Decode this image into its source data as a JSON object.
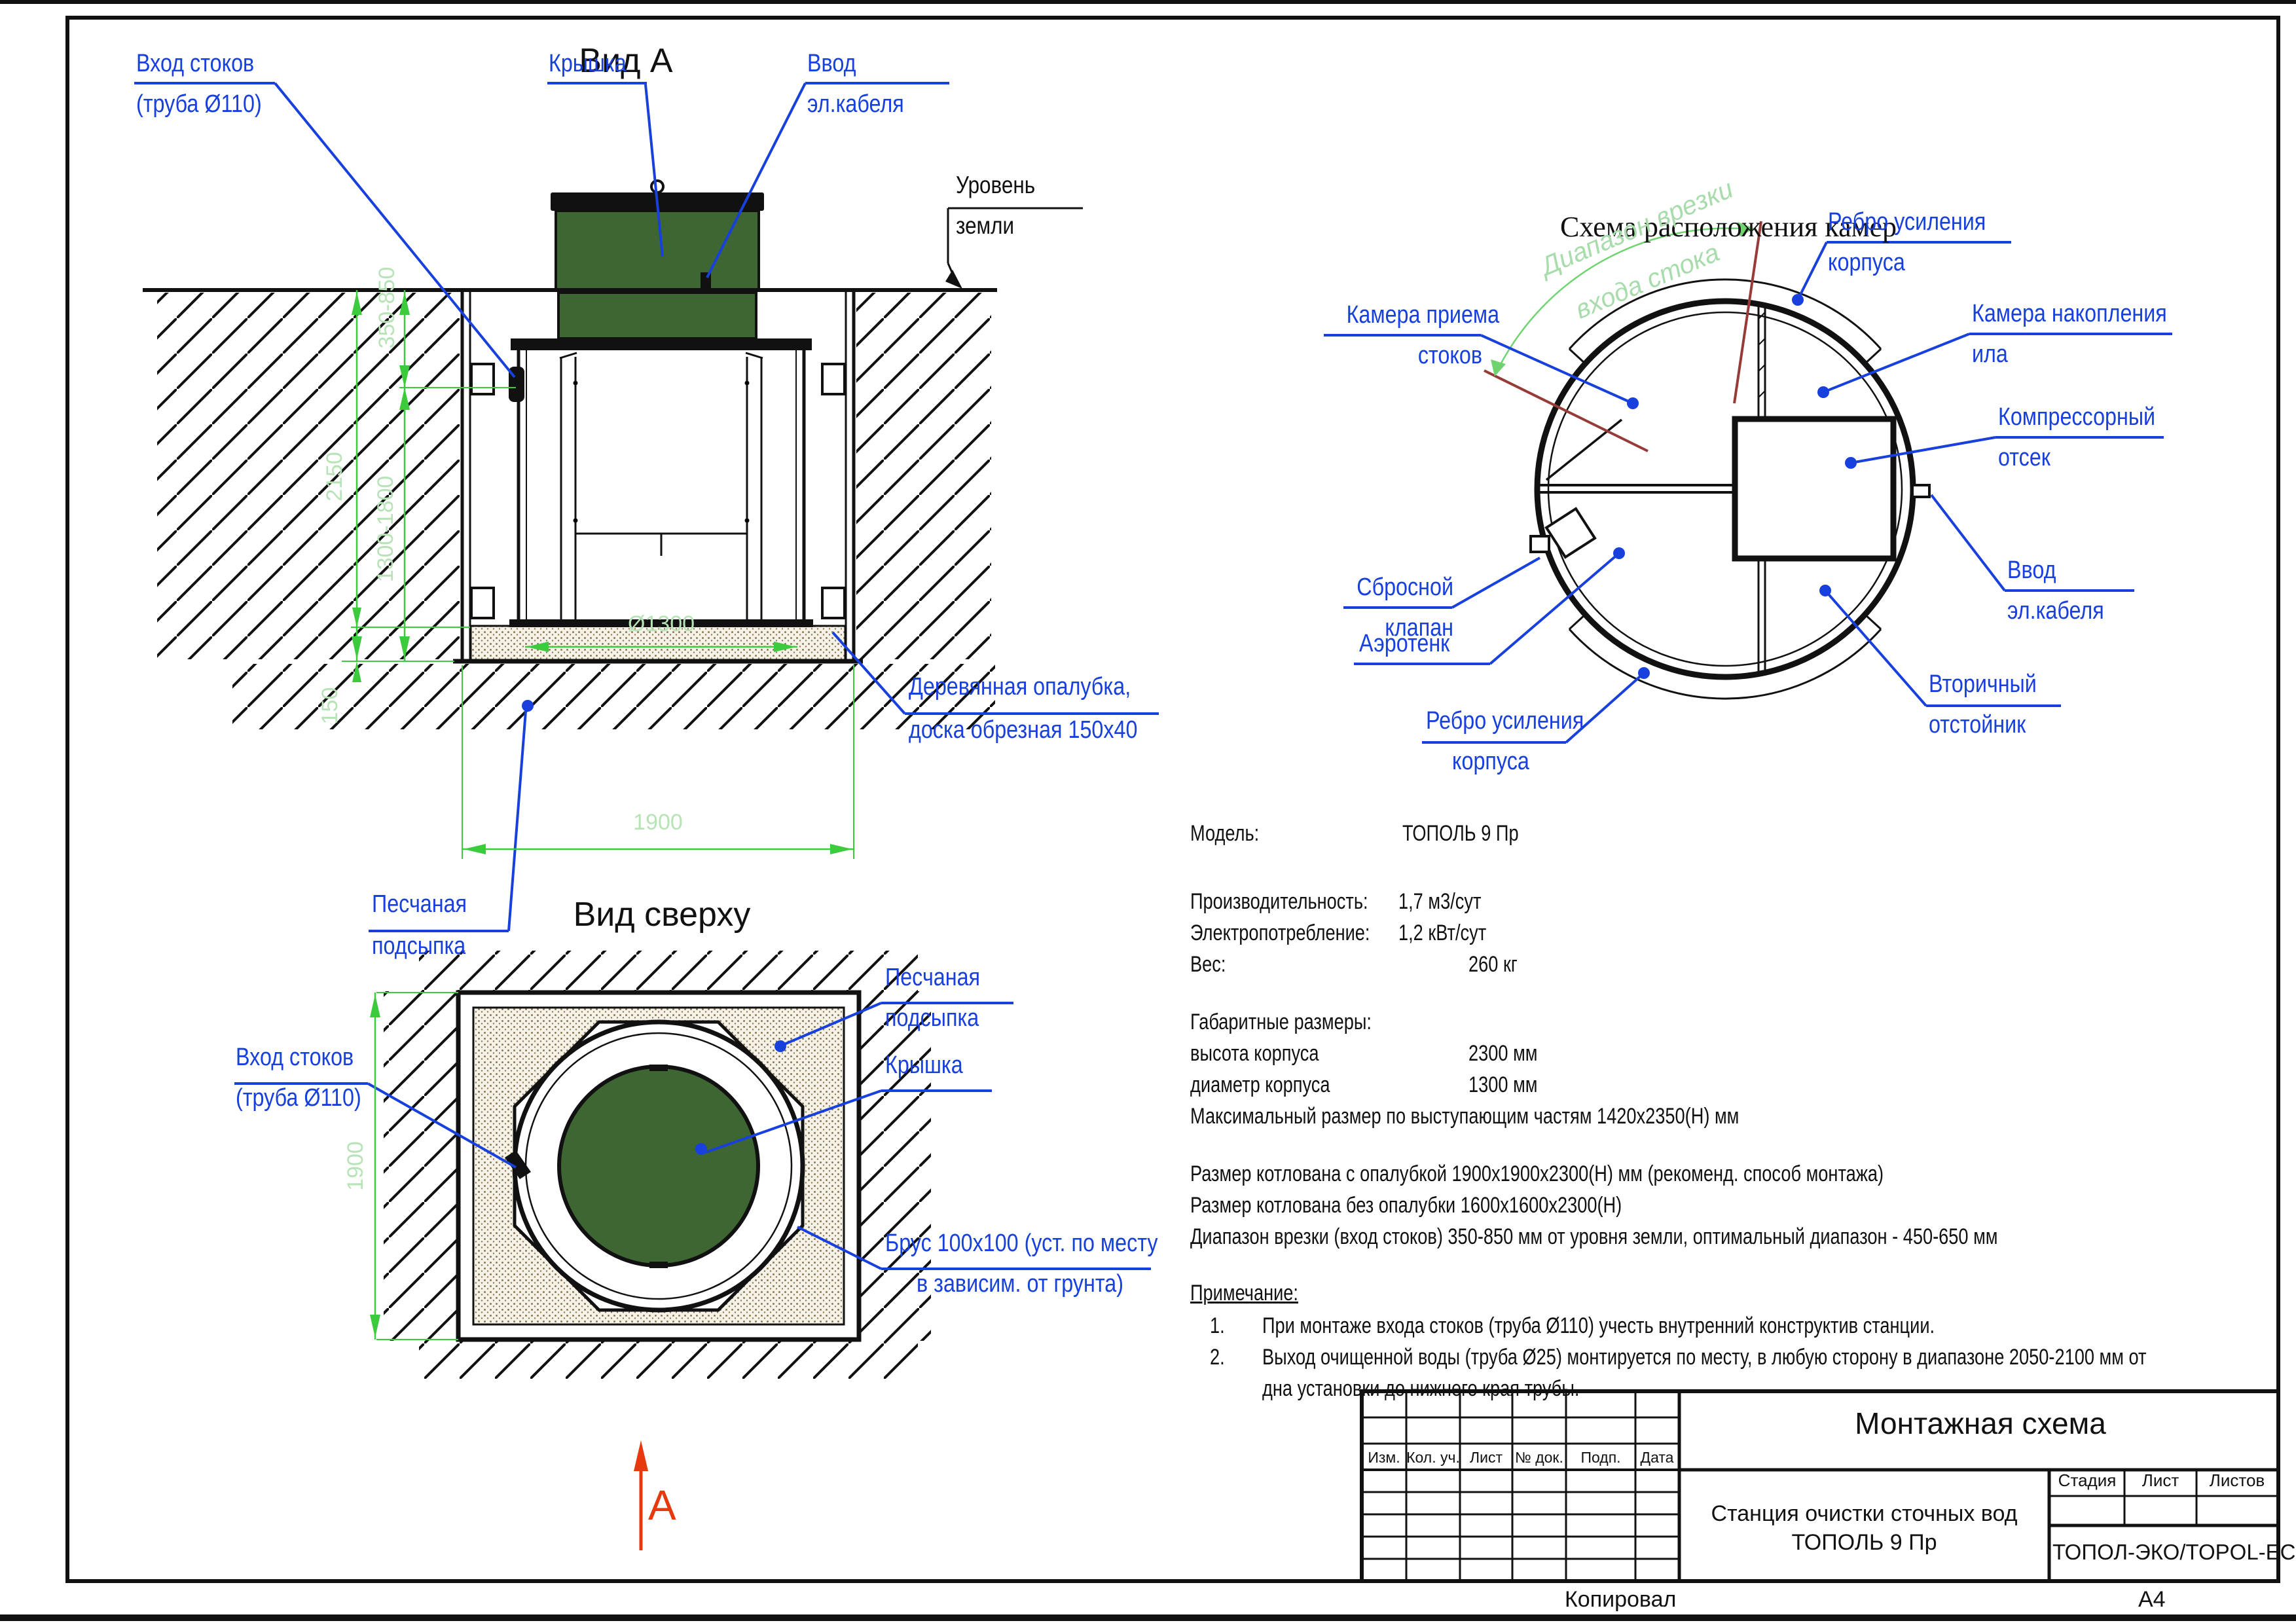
{
  "page": {
    "copied": "Копировал",
    "format": "А4"
  },
  "view_a": {
    "title": "Вид А",
    "labels": {
      "inlet1": "Вход стоков",
      "inlet2": "(труба Ø110)",
      "cover": "Крышка",
      "cable1": "Ввод",
      "cable2": "эл.кабеля",
      "ground1": "Уровень",
      "ground2": "земли",
      "formwork1": "Деревянная опалубка,",
      "formwork2": "доска обрезная 150х40",
      "sand1": "Песчаная",
      "sand2": "подсыпка"
    },
    "dims": {
      "depth_range": "350-850",
      "total_depth": "2150",
      "body_range": "1300-1800",
      "bedding": "150",
      "diameter": "Ø1300",
      "width": "1900"
    }
  },
  "top_view": {
    "title": "Вид сверху",
    "labels": {
      "inlet1": "Вход стоков",
      "inlet2": "(труба Ø110)",
      "sand1": "Песчаная",
      "sand2": "подсыпка",
      "cover": "Крышка",
      "beam1": "Брус 100х100 (уст. по месту",
      "beam2": "в зависим. от грунта)"
    },
    "dims": {
      "width": "1900"
    },
    "section_mark": "А"
  },
  "chambers": {
    "title": "Схема расположения камер",
    "range1": "Диапазон врезки",
    "range2": "входа стока",
    "labels": {
      "intake1": "Камера приема",
      "intake2": "стоков",
      "rib_top1": "Ребро усиления",
      "rib_top2": "корпуса",
      "sludge1": "Камера накопления",
      "sludge2": "ила",
      "compressor1": "Компрессорный",
      "compressor2": "отсек",
      "cable1": "Ввод",
      "cable2": "эл.кабеля",
      "valve1": "Сбросной",
      "valve2": "клапан",
      "aerotank": "Аэротенк",
      "rib_bottom1": "Ребро усиления",
      "rib_bottom2": "корпуса",
      "clarifier1": "Вторичный",
      "clarifier2": "отстойник"
    }
  },
  "specs": {
    "model_label": "Модель:",
    "model_value": "ТОПОЛЬ 9 Пр",
    "perf_label": "Производительность:",
    "perf_value": "1,7 м3/сут",
    "power_label": "Электропотребление:",
    "power_value": "1,2 кВт/сут",
    "weight_label": "Вес:",
    "weight_value": "260 кг",
    "size_header": "Габаритные размеры:",
    "height_label": "высота корпуса",
    "height_value": "2300 мм",
    "diameter_label": "диаметр корпуса",
    "diameter_value": "1300 мм",
    "max_size": "Максимальный размер по выступающим частям 1420х2350(Н) мм",
    "pit_with_formwork": "Размер котлована с опалубкой 1900х1900х2300(Н) мм (рекоменд. способ монтажа)",
    "pit_without_formwork": "Размер котлована без опалубки 1600х1600х2300(Н)",
    "inlet_range": "Диапазон врезки (вход стоков) 350-850 мм от уровня земли, оптимальный диапазон - 450-650 мм"
  },
  "notes": {
    "header": "Примечание:",
    "n1_num": "1.",
    "n1": "При монтаже входа  стоков (труба  Ø110) учесть внутренний конструктив станции.",
    "n2_num": "2.",
    "n2a": "Выход очищенной воды (труба Ø25) монтируется по месту, в любую сторону в диапазоне 2050-2100 мм от",
    "n2b": "дна установки до нижнего края трубы."
  },
  "stamp": {
    "title": "Монтажная схема",
    "cols": {
      "c1": "Изм.",
      "c2": "Кол. уч.",
      "c3": "Лист",
      "c4": "№ док.",
      "c5": "Подп.",
      "c6": "Дата"
    },
    "product1": "Станция очистки сточных вод",
    "product2": "ТОПОЛЬ 9 Пр",
    "stage": "Стадия",
    "sheet": "Лист",
    "sheets": "Листов",
    "company": "ТОПОЛ-ЭКО/TOPOL-ECO"
  }
}
